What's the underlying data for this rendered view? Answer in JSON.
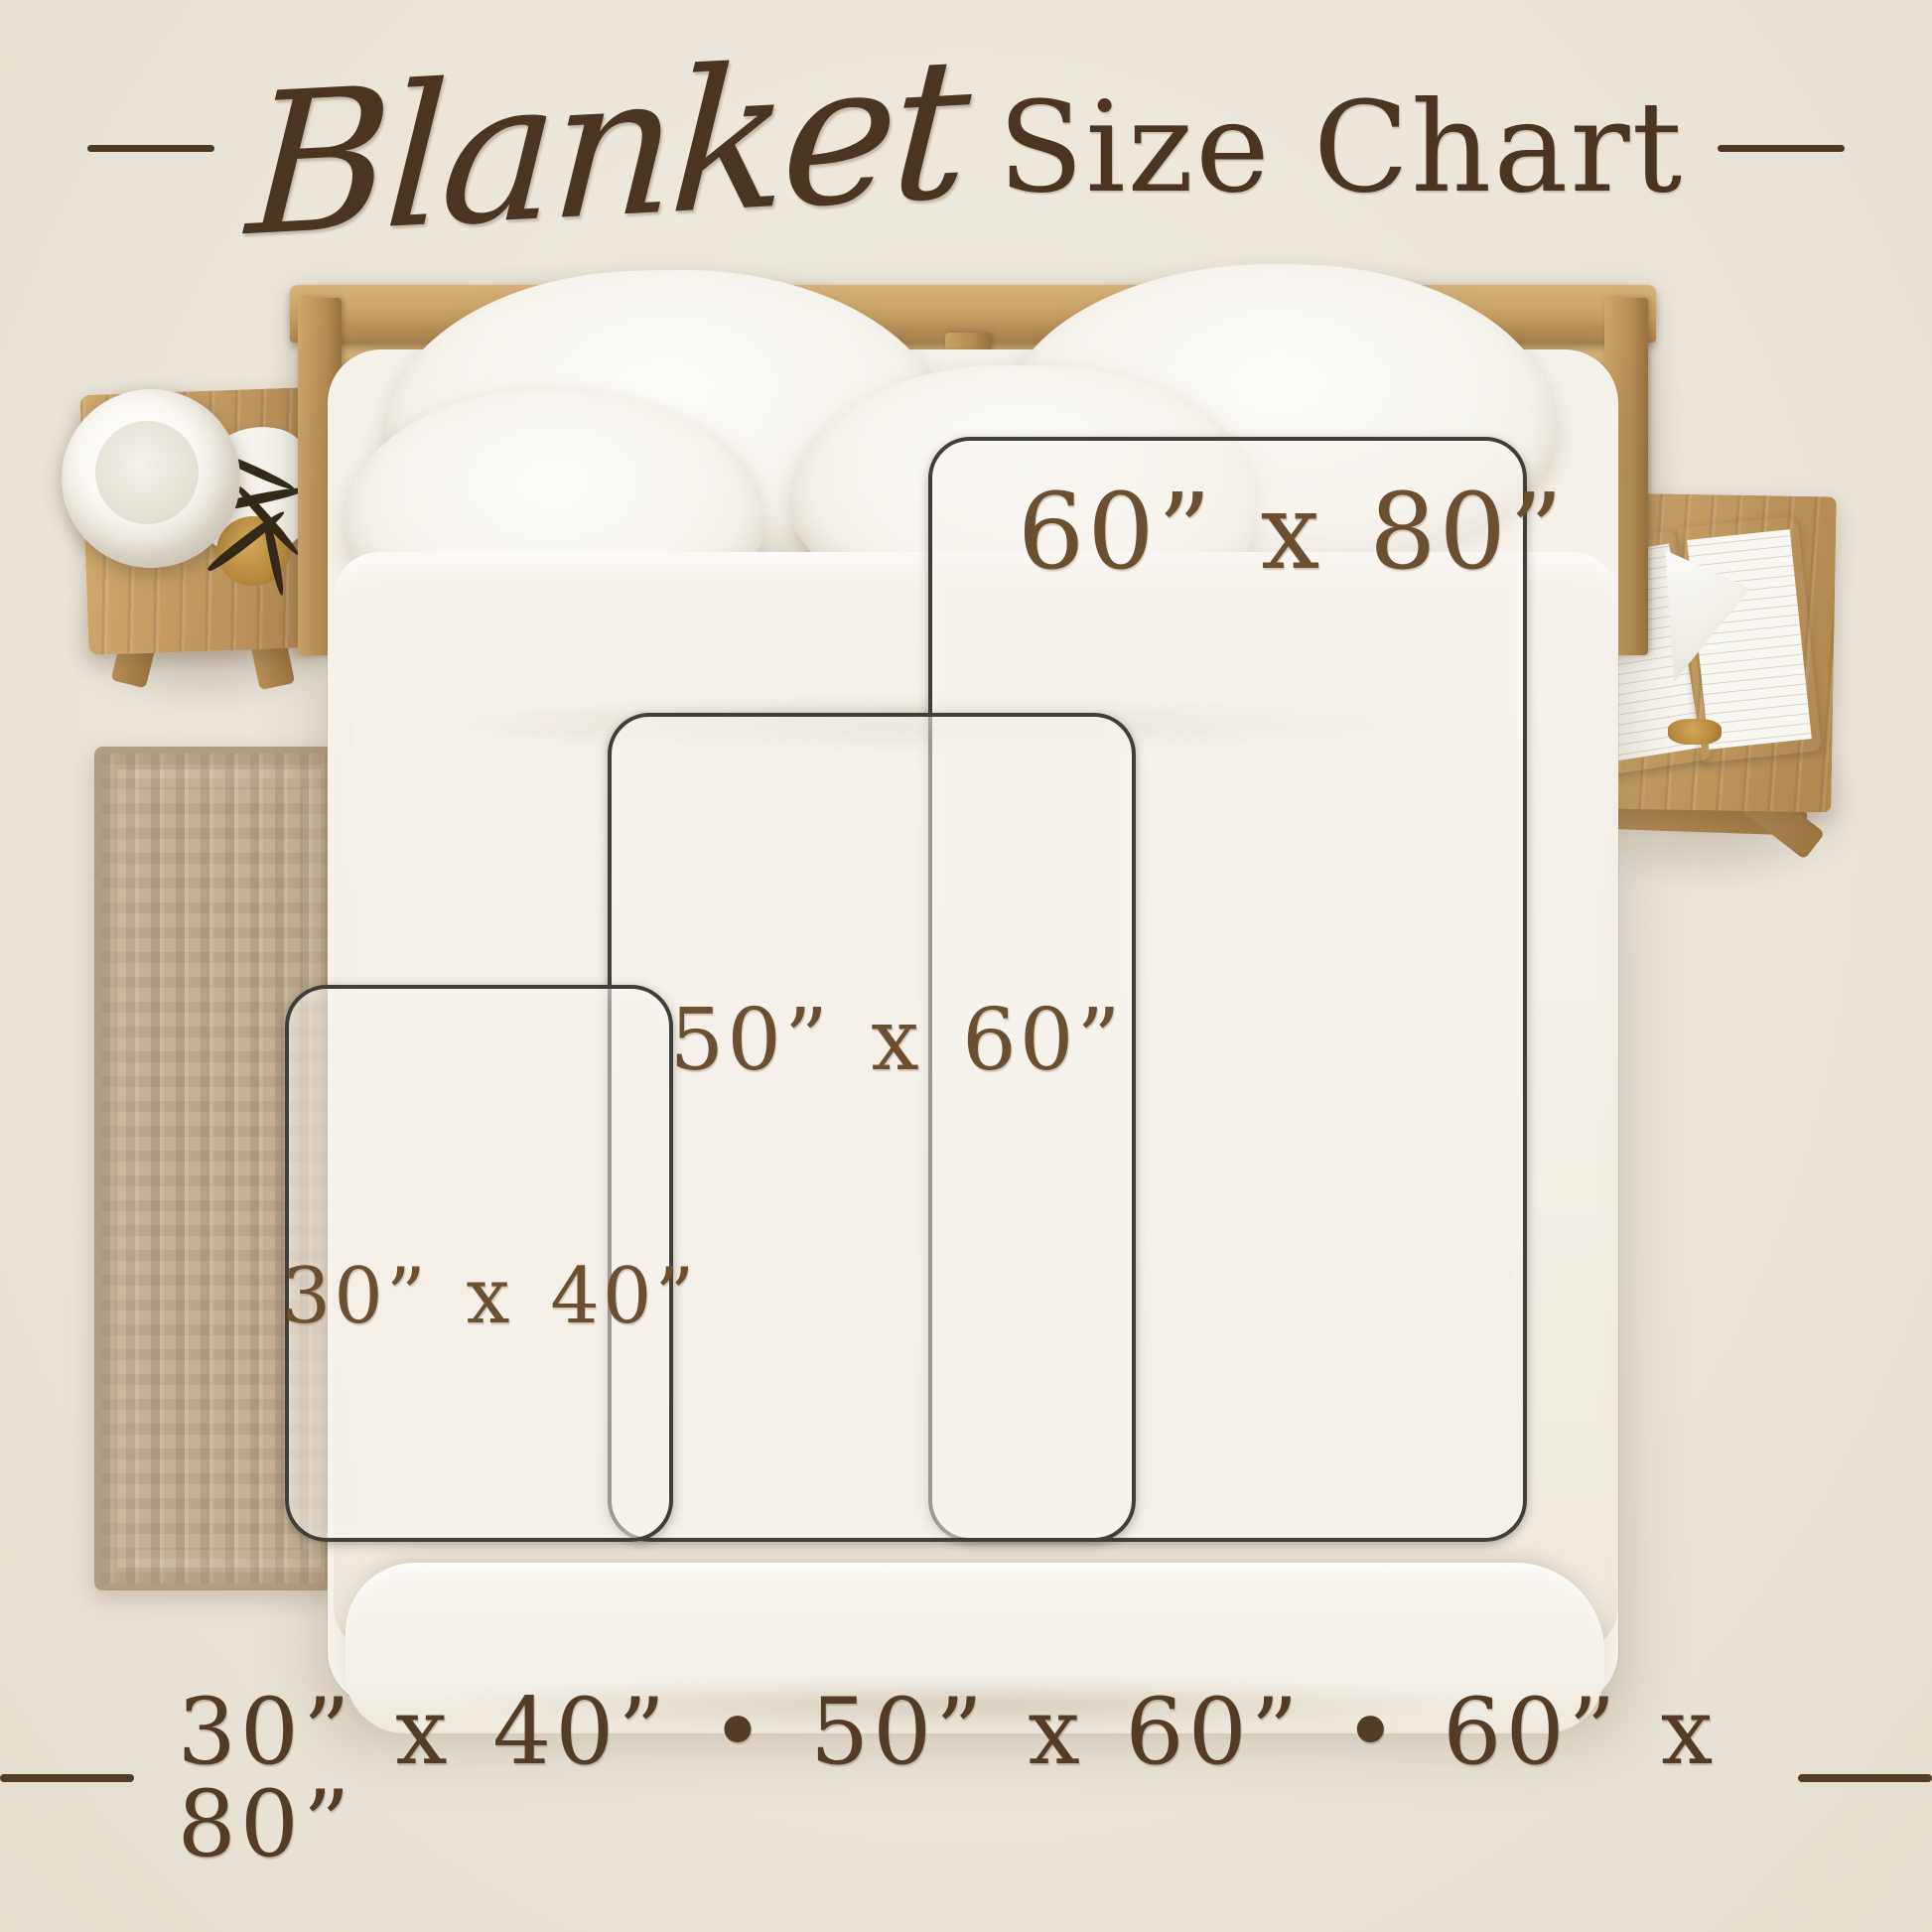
{
  "title": {
    "script": "Blanket",
    "rest": "Size Chart"
  },
  "sizes": [
    {
      "id": "30x40",
      "label": "30” x 40”",
      "width_in": 30,
      "height_in": 40
    },
    {
      "id": "50x60",
      "label": "50” x 60”",
      "width_in": 50,
      "height_in": 60
    },
    {
      "id": "60x80",
      "label": "60” x 80”",
      "width_in": 60,
      "height_in": 80
    }
  ],
  "footer": {
    "text": "30” x 40”  •  50” x 60”  •  60” x 80”"
  },
  "colors": {
    "background": "#ece6db",
    "title_text": "#4a3522",
    "label_text": "#6a4f31",
    "footer_text": "#533c26",
    "rect_outline": "#403e39",
    "wood": "#c49a62",
    "rug": "#c4b197",
    "bedding": "#f6f2ea"
  }
}
